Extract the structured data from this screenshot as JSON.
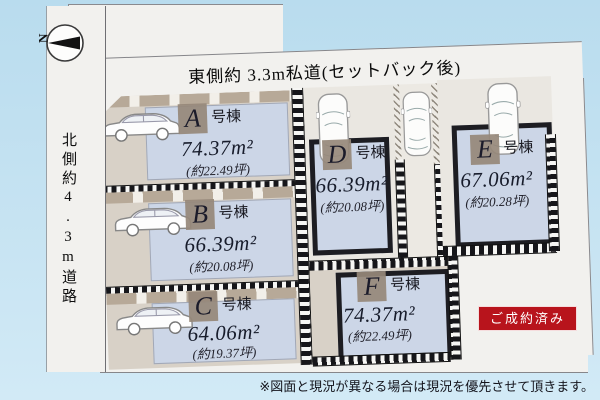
{
  "compass": {
    "north_label": "N"
  },
  "roads": {
    "top_label": "東側約 3.3m私道(セットバック後)",
    "left_label": "北側約4.3m道路"
  },
  "lots": [
    {
      "letter": "A",
      "suffix": "号棟",
      "area": "74.37m²",
      "tsubo": "(約22.49坪)"
    },
    {
      "letter": "B",
      "suffix": "号棟",
      "area": "66.39m²",
      "tsubo": "(約20.08坪)"
    },
    {
      "letter": "C",
      "suffix": "号棟",
      "area": "64.06m²",
      "tsubo": "(約19.37坪)"
    },
    {
      "letter": "D",
      "suffix": "号棟",
      "area": "66.39m²",
      "tsubo": "(約20.08坪)"
    },
    {
      "letter": "E",
      "suffix": "号棟",
      "area": "67.06m²",
      "tsubo": "(約20.28坪)"
    },
    {
      "letter": "F",
      "suffix": "号棟",
      "area": "74.37m²",
      "tsubo": "(約22.49坪)"
    }
  ],
  "badge": {
    "label": "ご成約済み",
    "color": "#b8141c"
  },
  "note": "※図面と現況が異なる場合は現況を優先させて頂きます。",
  "colors": {
    "background": "#c6e3f2",
    "parcel": "#f2f1ee",
    "building_footprint": "#ccd6e7",
    "driveway": "#d8d1c7",
    "badge_red": "#b8141c"
  }
}
